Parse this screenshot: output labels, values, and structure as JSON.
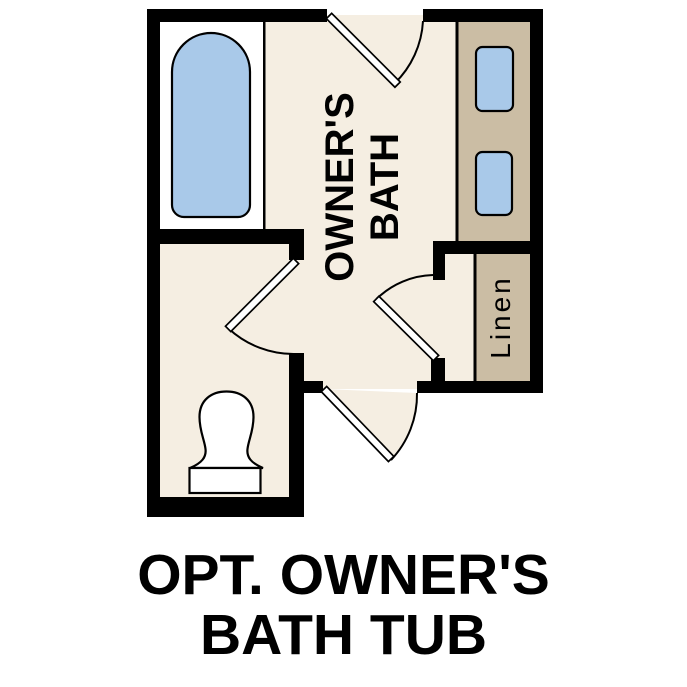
{
  "figure": {
    "type": "floor-plan",
    "caption": {
      "line1": "OPT. OWNER'S",
      "line2": "BATH TUB"
    },
    "rooms": {
      "owners_bath": {
        "label_line1": "OWNER'S",
        "label_line2": "BATH"
      },
      "linen_closet": {
        "label": "Linen"
      }
    },
    "fixtures": [
      "bathtub",
      "toilet",
      "vanity-counter",
      "sink-1",
      "sink-2"
    ],
    "doors": [
      "top-entry-door",
      "toilet-room-door",
      "bath-hall-door",
      "bottom-hall-door"
    ]
  },
  "colors": {
    "floor": "#F5EEE2",
    "cabinet": "#CBBDA4",
    "fixture_blue": "#A9C9E9",
    "wall": "#000000",
    "fixture_white": "#FFFFFF",
    "text": "#000000",
    "background": "#FFFFFF"
  }
}
